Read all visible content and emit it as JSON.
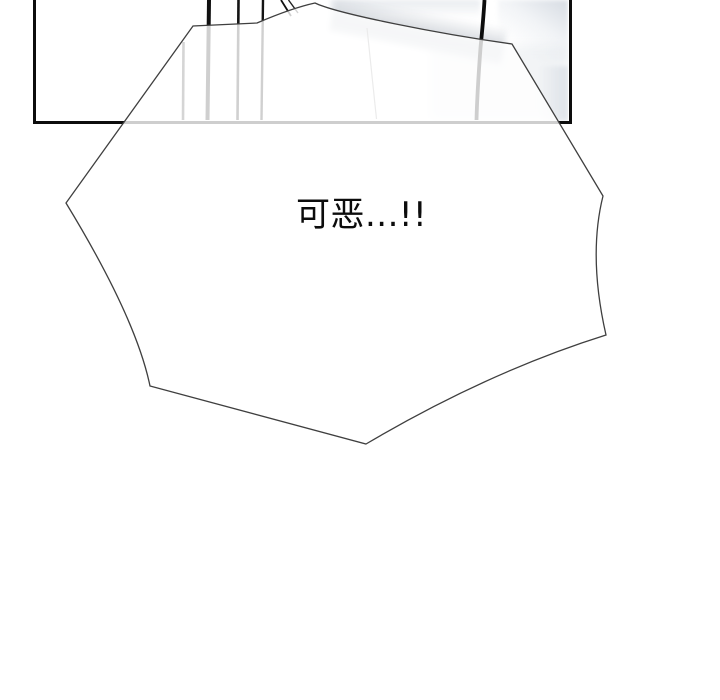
{
  "type": "comic-panel",
  "bubble": {
    "text": "可恶...!!",
    "fill": "rgba(255,255,255,0.8)"
  },
  "colors": {
    "background": "#ffffff",
    "panel_border": "#0d0d0d",
    "bubble_outline": "#3f3f3f",
    "text": "#0c0c0c",
    "sketch_line": "#101010",
    "faded_line_through_bubble": "#cccccc"
  }
}
